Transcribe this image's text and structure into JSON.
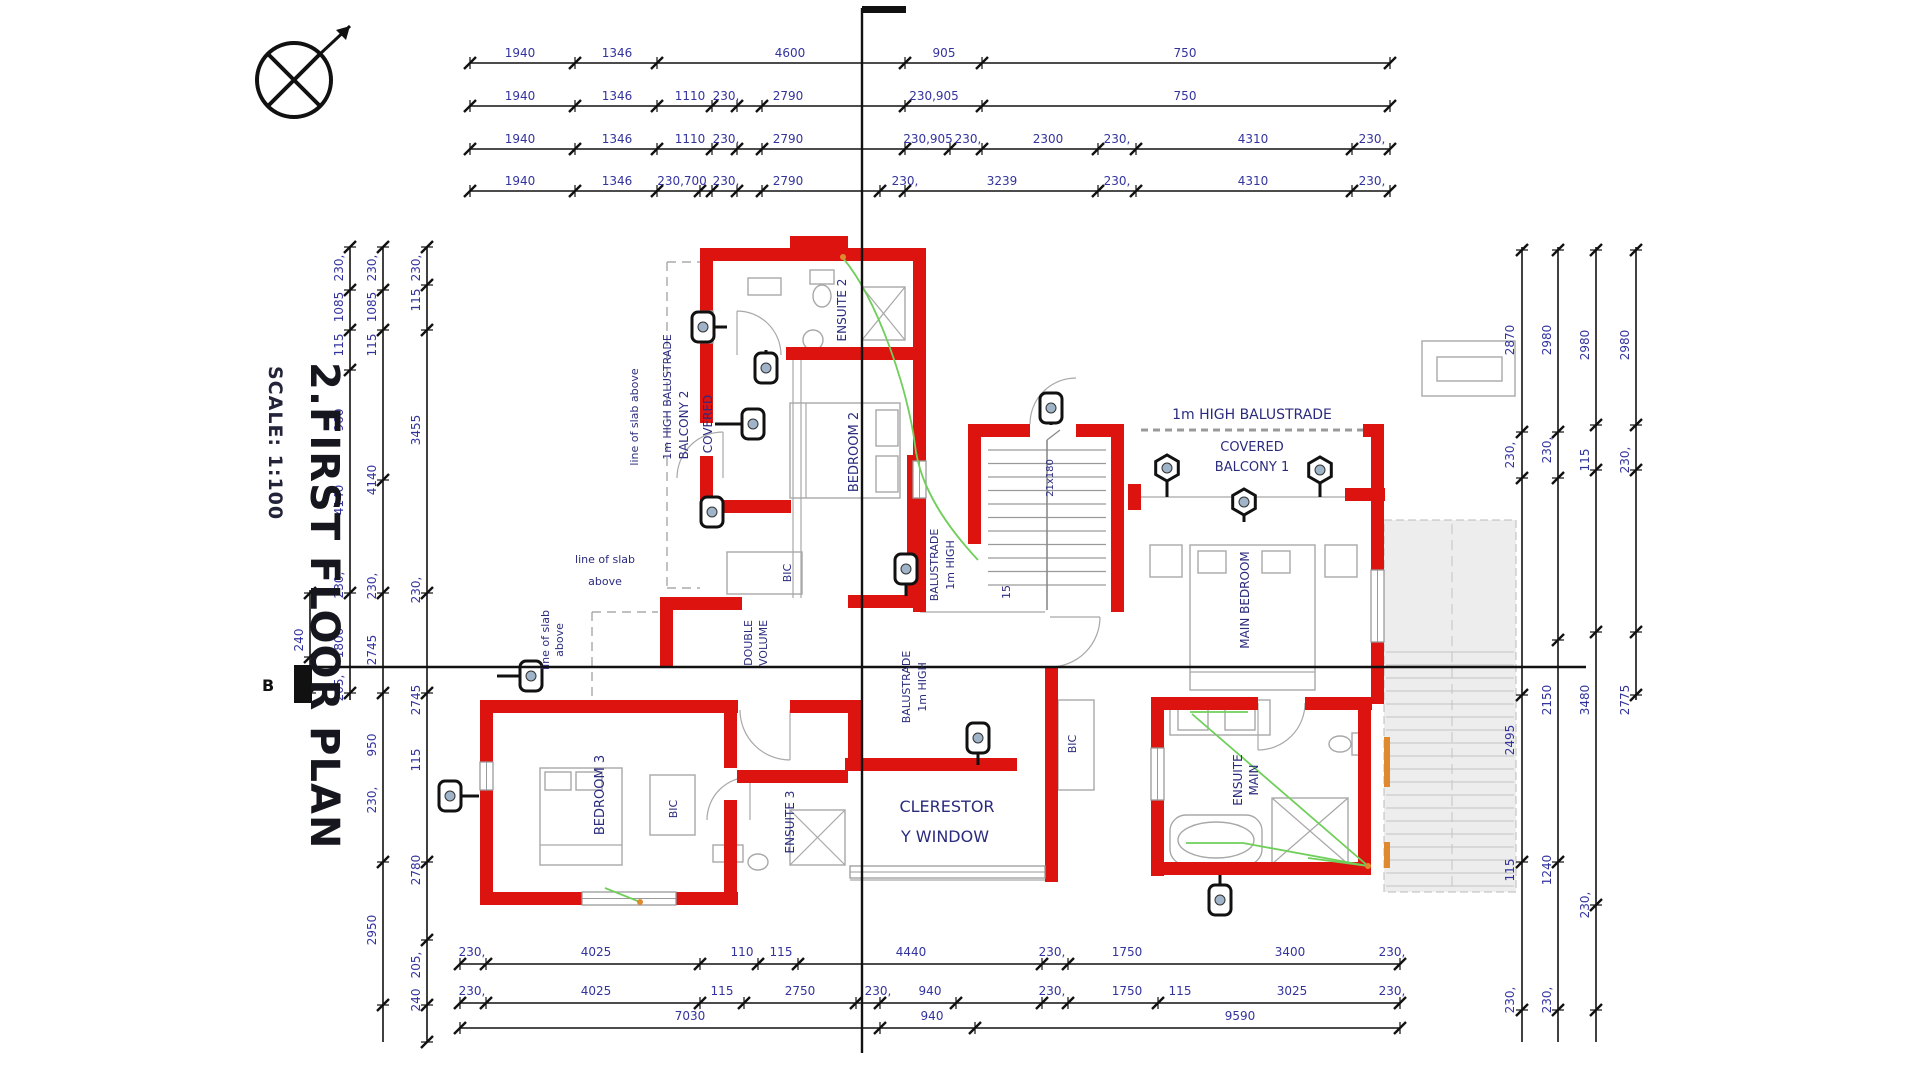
{
  "document": {
    "title": "2.FIRST FLOOR PLAN",
    "scale_label": "SCALE: 1:100",
    "section_letter": "B",
    "drawing_type": "first floor plan"
  },
  "colors": {
    "wall_red": "#dd1310",
    "dim_text": "#33339e",
    "room_text": "#2b2b7e",
    "line_black": "#1a1a1a",
    "grey": "#9a9a9a",
    "light_grey": "#c9c9c9",
    "deck_fill": "#ededed",
    "plank_grey": "#d2d2d2",
    "wire_green": "#6fcf5a",
    "accent_orange": "#e08a30"
  },
  "plan_texts": [
    {
      "t": "1940",
      "x": 520,
      "y": 57,
      "r": 0,
      "s": 12,
      "n": "dim-top"
    },
    {
      "t": "1346",
      "x": 617,
      "y": 57,
      "r": 0,
      "s": 12,
      "n": "dim-top"
    },
    {
      "t": "4600",
      "x": 790,
      "y": 57,
      "r": 0,
      "s": 12,
      "n": "dim-top"
    },
    {
      "t": "905",
      "x": 944,
      "y": 57,
      "r": 0,
      "s": 12,
      "n": "dim-top"
    },
    {
      "t": "750",
      "x": 1185,
      "y": 57,
      "r": 0,
      "s": 12,
      "n": "dim-top"
    },
    {
      "t": "1940",
      "x": 520,
      "y": 100,
      "r": 0,
      "s": 12,
      "n": "dim-top"
    },
    {
      "t": "1346",
      "x": 617,
      "y": 100,
      "r": 0,
      "s": 12,
      "n": "dim-top"
    },
    {
      "t": "1110",
      "x": 690,
      "y": 100,
      "r": 0,
      "s": 12,
      "n": "dim-top"
    },
    {
      "t": "230,",
      "x": 726,
      "y": 100,
      "r": 0,
      "s": 12,
      "n": "dim-top"
    },
    {
      "t": "2790",
      "x": 788,
      "y": 100,
      "r": 0,
      "s": 12,
      "n": "dim-top"
    },
    {
      "t": "230,905",
      "x": 934,
      "y": 100,
      "r": 0,
      "s": 12,
      "n": "dim-top"
    },
    {
      "t": "750",
      "x": 1185,
      "y": 100,
      "r": 0,
      "s": 12,
      "n": "dim-top"
    },
    {
      "t": "1940",
      "x": 520,
      "y": 143,
      "r": 0,
      "s": 12,
      "n": "dim-top"
    },
    {
      "t": "1346",
      "x": 617,
      "y": 143,
      "r": 0,
      "s": 12,
      "n": "dim-top"
    },
    {
      "t": "1110",
      "x": 690,
      "y": 143,
      "r": 0,
      "s": 12,
      "n": "dim-top"
    },
    {
      "t": "230,",
      "x": 726,
      "y": 143,
      "r": 0,
      "s": 12,
      "n": "dim-top"
    },
    {
      "t": "2790",
      "x": 788,
      "y": 143,
      "r": 0,
      "s": 12,
      "n": "dim-top"
    },
    {
      "t": "230,905",
      "x": 928,
      "y": 143,
      "r": 0,
      "s": 12,
      "n": "dim-top"
    },
    {
      "t": "230,",
      "x": 968,
      "y": 143,
      "r": 0,
      "s": 12,
      "n": "dim-top"
    },
    {
      "t": "2300",
      "x": 1048,
      "y": 143,
      "r": 0,
      "s": 12,
      "n": "dim-top"
    },
    {
      "t": "230,",
      "x": 1117,
      "y": 143,
      "r": 0,
      "s": 12,
      "n": "dim-top"
    },
    {
      "t": "4310",
      "x": 1253,
      "y": 143,
      "r": 0,
      "s": 12,
      "n": "dim-top"
    },
    {
      "t": "230,",
      "x": 1372,
      "y": 143,
      "r": 0,
      "s": 12,
      "n": "dim-top"
    },
    {
      "t": "1940",
      "x": 520,
      "y": 185,
      "r": 0,
      "s": 12,
      "n": "dim-top"
    },
    {
      "t": "1346",
      "x": 617,
      "y": 185,
      "r": 0,
      "s": 12,
      "n": "dim-top"
    },
    {
      "t": "230,700",
      "x": 682,
      "y": 185,
      "r": 0,
      "s": 12,
      "n": "dim-top"
    },
    {
      "t": "230,",
      "x": 726,
      "y": 185,
      "r": 0,
      "s": 12,
      "n": "dim-top"
    },
    {
      "t": "2790",
      "x": 788,
      "y": 185,
      "r": 0,
      "s": 12,
      "n": "dim-top"
    },
    {
      "t": "230,",
      "x": 905,
      "y": 185,
      "r": 0,
      "s": 12,
      "n": "dim-top"
    },
    {
      "t": "3239",
      "x": 1002,
      "y": 185,
      "r": 0,
      "s": 12,
      "n": "dim-top"
    },
    {
      "t": "230,",
      "x": 1117,
      "y": 185,
      "r": 0,
      "s": 12,
      "n": "dim-top"
    },
    {
      "t": "4310",
      "x": 1253,
      "y": 185,
      "r": 0,
      "s": 12,
      "n": "dim-top"
    },
    {
      "t": "230,",
      "x": 1372,
      "y": 185,
      "r": 0,
      "s": 12,
      "n": "dim-top"
    },
    {
      "t": "230,",
      "x": 472,
      "y": 956,
      "r": 0,
      "s": 12,
      "n": "dim-bottom"
    },
    {
      "t": "4025",
      "x": 596,
      "y": 956,
      "r": 0,
      "s": 12,
      "n": "dim-bottom"
    },
    {
      "t": "110",
      "x": 742,
      "y": 956,
      "r": 0,
      "s": 12,
      "n": "dim-bottom"
    },
    {
      "t": "115",
      "x": 781,
      "y": 956,
      "r": 0,
      "s": 12,
      "n": "dim-bottom"
    },
    {
      "t": "4440",
      "x": 911,
      "y": 956,
      "r": 0,
      "s": 12,
      "n": "dim-bottom"
    },
    {
      "t": "230,",
      "x": 1052,
      "y": 956,
      "r": 0,
      "s": 12,
      "n": "dim-bottom"
    },
    {
      "t": "1750",
      "x": 1127,
      "y": 956,
      "r": 0,
      "s": 12,
      "n": "dim-bottom"
    },
    {
      "t": "3400",
      "x": 1290,
      "y": 956,
      "r": 0,
      "s": 12,
      "n": "dim-bottom"
    },
    {
      "t": "230,",
      "x": 1392,
      "y": 956,
      "r": 0,
      "s": 12,
      "n": "dim-bottom"
    },
    {
      "t": "230,",
      "x": 472,
      "y": 995,
      "r": 0,
      "s": 12,
      "n": "dim-bottom"
    },
    {
      "t": "4025",
      "x": 596,
      "y": 995,
      "r": 0,
      "s": 12,
      "n": "dim-bottom"
    },
    {
      "t": "115",
      "x": 722,
      "y": 995,
      "r": 0,
      "s": 12,
      "n": "dim-bottom"
    },
    {
      "t": "2750",
      "x": 800,
      "y": 995,
      "r": 0,
      "s": 12,
      "n": "dim-bottom"
    },
    {
      "t": "230,",
      "x": 878,
      "y": 995,
      "r": 0,
      "s": 12,
      "n": "dim-bottom"
    },
    {
      "t": "940",
      "x": 930,
      "y": 995,
      "r": 0,
      "s": 12,
      "n": "dim-bottom"
    },
    {
      "t": "230,",
      "x": 1052,
      "y": 995,
      "r": 0,
      "s": 12,
      "n": "dim-bottom"
    },
    {
      "t": "1750",
      "x": 1127,
      "y": 995,
      "r": 0,
      "s": 12,
      "n": "dim-bottom"
    },
    {
      "t": "115",
      "x": 1180,
      "y": 995,
      "r": 0,
      "s": 12,
      "n": "dim-bottom"
    },
    {
      "t": "3025",
      "x": 1292,
      "y": 995,
      "r": 0,
      "s": 12,
      "n": "dim-bottom"
    },
    {
      "t": "230,",
      "x": 1392,
      "y": 995,
      "r": 0,
      "s": 12,
      "n": "dim-bottom"
    },
    {
      "t": "7030",
      "x": 690,
      "y": 1020,
      "r": 0,
      "s": 12,
      "n": "dim-bottom"
    },
    {
      "t": "940",
      "x": 932,
      "y": 1020,
      "r": 0,
      "s": 12,
      "n": "dim-bottom"
    },
    {
      "t": "9590",
      "x": 1240,
      "y": 1020,
      "r": 0,
      "s": 12,
      "n": "dim-bottom"
    },
    {
      "t": "230,",
      "x": 343,
      "y": 268,
      "r": -90,
      "s": 12,
      "n": "dim-left"
    },
    {
      "t": "1085",
      "x": 343,
      "y": 307,
      "r": -90,
      "s": 12,
      "n": "dim-left"
    },
    {
      "t": "115",
      "x": 343,
      "y": 345,
      "r": -90,
      "s": 12,
      "n": "dim-left"
    },
    {
      "t": "960",
      "x": 343,
      "y": 420,
      "r": -90,
      "s": 12,
      "n": "dim-left"
    },
    {
      "t": "4140",
      "x": 343,
      "y": 500,
      "r": -90,
      "s": 12,
      "n": "dim-left"
    },
    {
      "t": "230,",
      "x": 343,
      "y": 585,
      "r": -90,
      "s": 12,
      "n": "dim-left"
    },
    {
      "t": "1800",
      "x": 343,
      "y": 643,
      "r": -90,
      "s": 12,
      "n": "dim-left"
    },
    {
      "t": "205,",
      "x": 343,
      "y": 688,
      "r": -90,
      "s": 12,
      "n": "dim-left"
    },
    {
      "t": "230,",
      "x": 376,
      "y": 268,
      "r": -90,
      "s": 12,
      "n": "dim-left"
    },
    {
      "t": "1085",
      "x": 376,
      "y": 307,
      "r": -90,
      "s": 12,
      "n": "dim-left"
    },
    {
      "t": "115",
      "x": 376,
      "y": 345,
      "r": -90,
      "s": 12,
      "n": "dim-left"
    },
    {
      "t": "4140",
      "x": 376,
      "y": 480,
      "r": -90,
      "s": 12,
      "n": "dim-left"
    },
    {
      "t": "230,",
      "x": 376,
      "y": 586,
      "r": -90,
      "s": 12,
      "n": "dim-left"
    },
    {
      "t": "2745",
      "x": 376,
      "y": 650,
      "r": -90,
      "s": 12,
      "n": "dim-left"
    },
    {
      "t": "950",
      "x": 376,
      "y": 745,
      "r": -90,
      "s": 12,
      "n": "dim-left"
    },
    {
      "t": "230,",
      "x": 376,
      "y": 800,
      "r": -90,
      "s": 12,
      "n": "dim-left"
    },
    {
      "t": "2950",
      "x": 376,
      "y": 930,
      "r": -90,
      "s": 12,
      "n": "dim-left"
    },
    {
      "t": "230,",
      "x": 420,
      "y": 268,
      "r": -90,
      "s": 12,
      "n": "dim-left"
    },
    {
      "t": "115",
      "x": 420,
      "y": 300,
      "r": -90,
      "s": 12,
      "n": "dim-left"
    },
    {
      "t": "3455",
      "x": 420,
      "y": 430,
      "r": -90,
      "s": 12,
      "n": "dim-left"
    },
    {
      "t": "230,",
      "x": 420,
      "y": 590,
      "r": -90,
      "s": 12,
      "n": "dim-left"
    },
    {
      "t": "2745",
      "x": 420,
      "y": 700,
      "r": -90,
      "s": 12,
      "n": "dim-left"
    },
    {
      "t": "115",
      "x": 420,
      "y": 760,
      "r": -90,
      "s": 12,
      "n": "dim-left"
    },
    {
      "t": "2780",
      "x": 420,
      "y": 870,
      "r": -90,
      "s": 12,
      "n": "dim-left"
    },
    {
      "t": "205,",
      "x": 420,
      "y": 965,
      "r": -90,
      "s": 12,
      "n": "dim-left"
    },
    {
      "t": "240",
      "x": 420,
      "y": 1000,
      "r": -90,
      "s": 12,
      "n": "dim-left"
    },
    {
      "t": "240",
      "x": 303,
      "y": 640,
      "r": -90,
      "s": 12,
      "n": "dim-left"
    },
    {
      "t": "2870",
      "x": 1514,
      "y": 340,
      "r": -90,
      "s": 12,
      "n": "dim-right"
    },
    {
      "t": "230,",
      "x": 1514,
      "y": 455,
      "r": -90,
      "s": 12,
      "n": "dim-right"
    },
    {
      "t": "2495",
      "x": 1514,
      "y": 740,
      "r": -90,
      "s": 12,
      "n": "dim-right"
    },
    {
      "t": "115",
      "x": 1514,
      "y": 870,
      "r": -90,
      "s": 12,
      "n": "dim-right"
    },
    {
      "t": "230,",
      "x": 1514,
      "y": 1000,
      "r": -90,
      "s": 12,
      "n": "dim-right"
    },
    {
      "t": "2980",
      "x": 1551,
      "y": 340,
      "r": -90,
      "s": 12,
      "n": "dim-right"
    },
    {
      "t": "230,",
      "x": 1551,
      "y": 450,
      "r": -90,
      "s": 12,
      "n": "dim-right"
    },
    {
      "t": "2150",
      "x": 1551,
      "y": 700,
      "r": -90,
      "s": 12,
      "n": "dim-right"
    },
    {
      "t": "1240",
      "x": 1551,
      "y": 870,
      "r": -90,
      "s": 12,
      "n": "dim-right"
    },
    {
      "t": "230,",
      "x": 1551,
      "y": 1000,
      "r": -90,
      "s": 12,
      "n": "dim-right"
    },
    {
      "t": "2980",
      "x": 1589,
      "y": 345,
      "r": -90,
      "s": 12,
      "n": "dim-right"
    },
    {
      "t": "115",
      "x": 1589,
      "y": 460,
      "r": -90,
      "s": 12,
      "n": "dim-right"
    },
    {
      "t": "3480",
      "x": 1589,
      "y": 700,
      "r": -90,
      "s": 12,
      "n": "dim-right"
    },
    {
      "t": "230,",
      "x": 1589,
      "y": 905,
      "r": -90,
      "s": 12,
      "n": "dim-right"
    },
    {
      "t": "2980",
      "x": 1629,
      "y": 345,
      "r": -90,
      "s": 12,
      "n": "dim-right"
    },
    {
      "t": "230,",
      "x": 1629,
      "y": 460,
      "r": -90,
      "s": 12,
      "n": "dim-right"
    },
    {
      "t": "2775",
      "x": 1629,
      "y": 700,
      "r": -90,
      "s": 12,
      "n": "dim-right"
    },
    {
      "t": "ENSUITE 2",
      "x": 846,
      "y": 310,
      "r": -90,
      "s": 12,
      "c": "room_text",
      "n": "room-label"
    },
    {
      "t": "BEDROOM 2",
      "x": 858,
      "y": 452,
      "r": -90,
      "s": 13,
      "c": "room_text",
      "n": "room-label"
    },
    {
      "t": "BALCONY 2",
      "x": 688,
      "y": 425,
      "r": -90,
      "s": 12,
      "c": "room_text",
      "n": "room-label"
    },
    {
      "t": "COVERED",
      "x": 712,
      "y": 424,
      "r": -90,
      "s": 12,
      "c": "room_text",
      "n": "room-label"
    },
    {
      "t": "1m HIGH BALUSTRADE",
      "x": 671,
      "y": 397,
      "r": -90,
      "s": 11,
      "c": "room_text",
      "n": "annotation"
    },
    {
      "t": "line of slab above",
      "x": 638,
      "y": 417,
      "r": -90,
      "s": 11,
      "c": "room_text",
      "n": "annotation"
    },
    {
      "t": "line of slab",
      "x": 549,
      "y": 640,
      "r": -90,
      "s": 11,
      "c": "room_text",
      "n": "annotation"
    },
    {
      "t": "above",
      "x": 563,
      "y": 640,
      "r": -90,
      "s": 11,
      "c": "room_text",
      "n": "annotation"
    },
    {
      "t": "line of slab",
      "x": 605,
      "y": 563,
      "r": 0,
      "s": 11,
      "c": "room_text",
      "n": "annotation"
    },
    {
      "t": "above",
      "x": 605,
      "y": 585,
      "r": 0,
      "s": 11,
      "c": "room_text",
      "n": "annotation"
    },
    {
      "t": "BIC",
      "x": 791,
      "y": 573,
      "r": -90,
      "s": 11,
      "c": "room_text",
      "n": "room-label"
    },
    {
      "t": "BALUSTRADE",
      "x": 938,
      "y": 565,
      "r": -90,
      "s": 11,
      "c": "room_text",
      "n": "annotation"
    },
    {
      "t": "1m HIGH",
      "x": 954,
      "y": 565,
      "r": -90,
      "s": 11,
      "c": "room_text",
      "n": "annotation"
    },
    {
      "t": "21x180",
      "x": 1053,
      "y": 478,
      "r": -90,
      "s": 10,
      "c": "room_text",
      "n": "stair-note"
    },
    {
      "t": "15",
      "x": 1010,
      "y": 592,
      "r": -90,
      "s": 11,
      "c": "room_text",
      "n": "stair-note"
    },
    {
      "t": "DOUBLE",
      "x": 752,
      "y": 643,
      "r": -90,
      "s": 11,
      "c": "room_text",
      "n": "annotation"
    },
    {
      "t": "VOLUME",
      "x": 767,
      "y": 643,
      "r": -90,
      "s": 11,
      "c": "room_text",
      "n": "annotation"
    },
    {
      "t": "BALUSTRADE",
      "x": 910,
      "y": 687,
      "r": -90,
      "s": 11,
      "c": "room_text",
      "n": "annotation"
    },
    {
      "t": "1m HIGH",
      "x": 926,
      "y": 687,
      "r": -90,
      "s": 11,
      "c": "room_text",
      "n": "annotation"
    },
    {
      "t": "1m HIGH BALUSTRADE",
      "x": 1252,
      "y": 419,
      "r": 0,
      "s": 14,
      "c": "room_text",
      "n": "annotation"
    },
    {
      "t": "COVERED",
      "x": 1252,
      "y": 451,
      "r": 0,
      "s": 13,
      "c": "room_text",
      "n": "room-label"
    },
    {
      "t": "BALCONY 1",
      "x": 1252,
      "y": 471,
      "r": 0,
      "s": 13,
      "c": "room_text",
      "n": "room-label"
    },
    {
      "t": "MAIN BEDROOM",
      "x": 1249,
      "y": 600,
      "r": -90,
      "s": 12,
      "c": "room_text",
      "n": "room-label"
    },
    {
      "t": "ENSUITE",
      "x": 1242,
      "y": 780,
      "r": -90,
      "s": 12,
      "c": "room_text",
      "n": "room-label"
    },
    {
      "t": "MAIN",
      "x": 1258,
      "y": 780,
      "r": -90,
      "s": 12,
      "c": "room_text",
      "n": "room-label"
    },
    {
      "t": "BEDROOM 3",
      "x": 604,
      "y": 795,
      "r": -90,
      "s": 13,
      "c": "room_text",
      "n": "room-label"
    },
    {
      "t": "BIC",
      "x": 677,
      "y": 809,
      "r": -90,
      "s": 11,
      "c": "room_text",
      "n": "room-label"
    },
    {
      "t": "ENSUITE 3",
      "x": 794,
      "y": 822,
      "r": -90,
      "s": 12,
      "c": "room_text",
      "n": "room-label"
    },
    {
      "t": "CLERESTOR",
      "x": 947,
      "y": 812,
      "r": 0,
      "s": 16,
      "c": "room_text",
      "n": "annotation"
    },
    {
      "t": "Y WINDOW",
      "x": 945,
      "y": 842,
      "r": 0,
      "s": 16,
      "c": "room_text",
      "n": "annotation"
    },
    {
      "t": "BIC",
      "x": 1076,
      "y": 744,
      "r": -90,
      "s": 11,
      "c": "room_text",
      "n": "room-label"
    }
  ]
}
